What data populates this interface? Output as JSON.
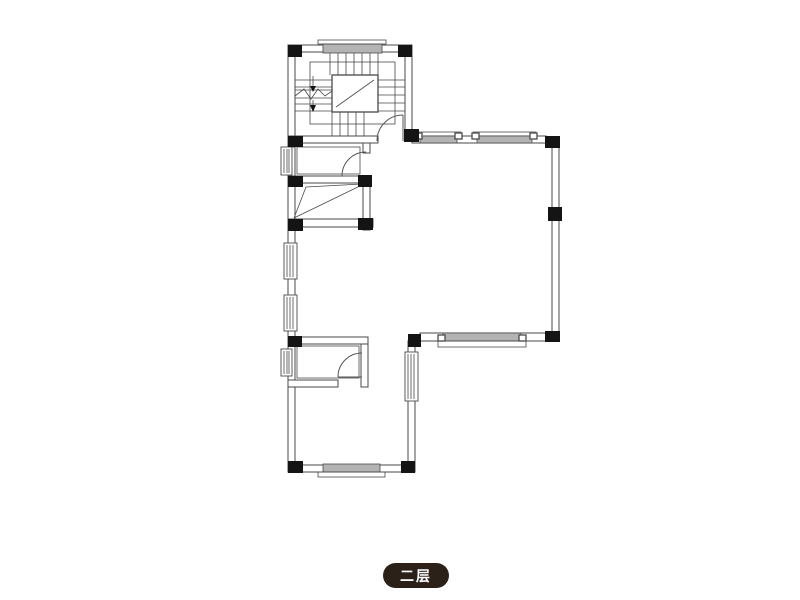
{
  "page": {
    "background_color": "#ffffff"
  },
  "floor_label": {
    "text": "二层",
    "bg_color": "#2b2119",
    "text_color": "#ffffff"
  },
  "plan": {
    "type": "architectural-floor-plan",
    "line_color": "#4a4a4a",
    "column_color": "#141414",
    "window_fill_color": "#b3b3b3",
    "stair_direction_arrows": "down",
    "door_count": 3,
    "window_count": 10,
    "column_count": 15
  }
}
